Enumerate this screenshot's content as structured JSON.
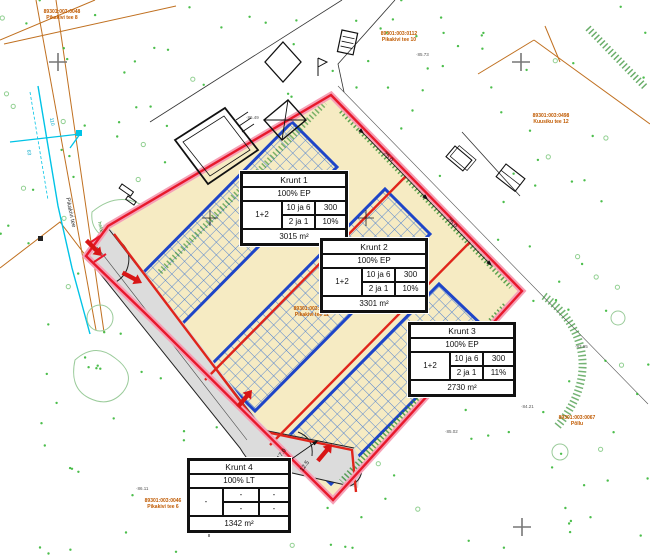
{
  "map": {
    "title": "Detailplaneering / krundijaotus",
    "plots": [
      {
        "name": "Krunt 1",
        "use": "100% EP",
        "row1": [
          "10 ja 6",
          "300"
        ],
        "row2": [
          "2 ja 1",
          "10%"
        ],
        "floors": "1+2",
        "area": "3015 m²"
      },
      {
        "name": "Krunt 2",
        "use": "100% EP",
        "row1": [
          "10 ja 6",
          "300"
        ],
        "row2": [
          "2 ja 1",
          "10%"
        ],
        "floors": "1+2",
        "area": "3301 m²"
      },
      {
        "name": "Krunt 3",
        "use": "100% EP",
        "row1": [
          "10 ja 6",
          "300"
        ],
        "row2": [
          "2 ja 1",
          "11%"
        ],
        "floors": "1+2",
        "area": "2730 m²"
      },
      {
        "name": "Krunt 4",
        "use": "100% LT",
        "row1": [
          "-",
          "-"
        ],
        "row2": [
          "-",
          "-"
        ],
        "floors": "-",
        "area": "1342 m²"
      }
    ],
    "cadastral_labels": [
      {
        "line1": "89301:003:0048",
        "line2": "Pikakivi tee 8"
      },
      {
        "line1": "89301:003:0112",
        "line2": "Pikakivi tee 10"
      },
      {
        "line1": "89301:003:0498",
        "line2": "Kuusiku tee 12"
      },
      {
        "line1": "89301:003:0070",
        "line2": "Pikakivi tee 12"
      },
      {
        "line1": "89301:003:0046",
        "line2": "Pikakivi tee 6"
      },
      {
        "line1": "89301:003:0067",
        "line2": "Põllu"
      }
    ],
    "street_label": "Pikakivi tee",
    "hedge_label": "hekk",
    "utility_labels": [
      "110",
      "63"
    ],
    "dimension_labels": [
      "25.0",
      "25.0",
      "17.0",
      "12.5"
    ],
    "elevation_labels": [
      "·86.49",
      "·85.73",
      "·85.02",
      "·84.21",
      "·83.95",
      "·86.11"
    ],
    "colors": {
      "boundary_red": "#E8192C",
      "boundary_glow": "#F5A0B6",
      "division_red": "#E0251B",
      "envelope_blue": "#1E45C8",
      "hatch_blue": "#4D7FD0",
      "plot_fill": "#F6EBC3",
      "road_gray": "#DCDCDC",
      "vegetation_green": "#2DB32D",
      "hedge_green": "#2A8A2A",
      "utility_cyan": "#00C3E6",
      "cadastral_orange": "#C05A00"
    }
  }
}
